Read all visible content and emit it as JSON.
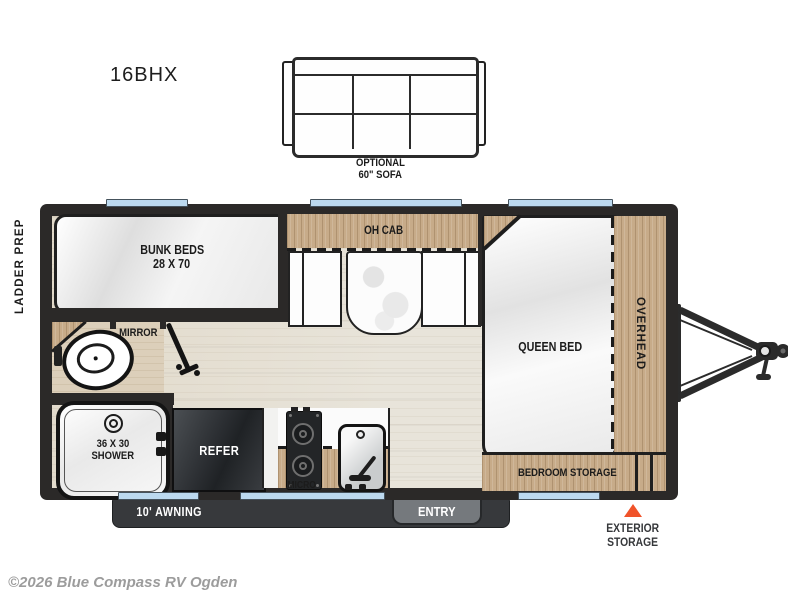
{
  "title": "16BHX",
  "sofa": {
    "line1": "OPTIONAL",
    "line2": "60\" SOFA"
  },
  "labels": {
    "ladder_prep": "LADDER PREP",
    "bunk_line1": "BUNK BEDS",
    "bunk_line2": "28 X 70",
    "mirror": "MIRROR",
    "oh_cab": "OH CAB",
    "queen_bed": "QUEEN BED",
    "overhead": "OVERHEAD",
    "bedroom_storage": "BEDROOM STORAGE",
    "shower_line1": "36 X 30",
    "shower_line2": "SHOWER",
    "refer": "REFER",
    "micro": "MICRO",
    "awning": "10' AWNING",
    "entry": "ENTRY",
    "exterior_storage_line1": "EXTERIOR",
    "exterior_storage_line2": "STORAGE"
  },
  "footer": {
    "copyright": "©2026 Blue Compass RV Ogden"
  },
  "colors": {
    "wall": "#2b2928",
    "cabinet_wood": "#c7ab89",
    "floor": "#e8e4da",
    "window_glass": "#bcd9ef",
    "exterior_storage_marker": "#f0532a",
    "awning_bar": "#37393c",
    "entry_tab": "#75797d"
  }
}
